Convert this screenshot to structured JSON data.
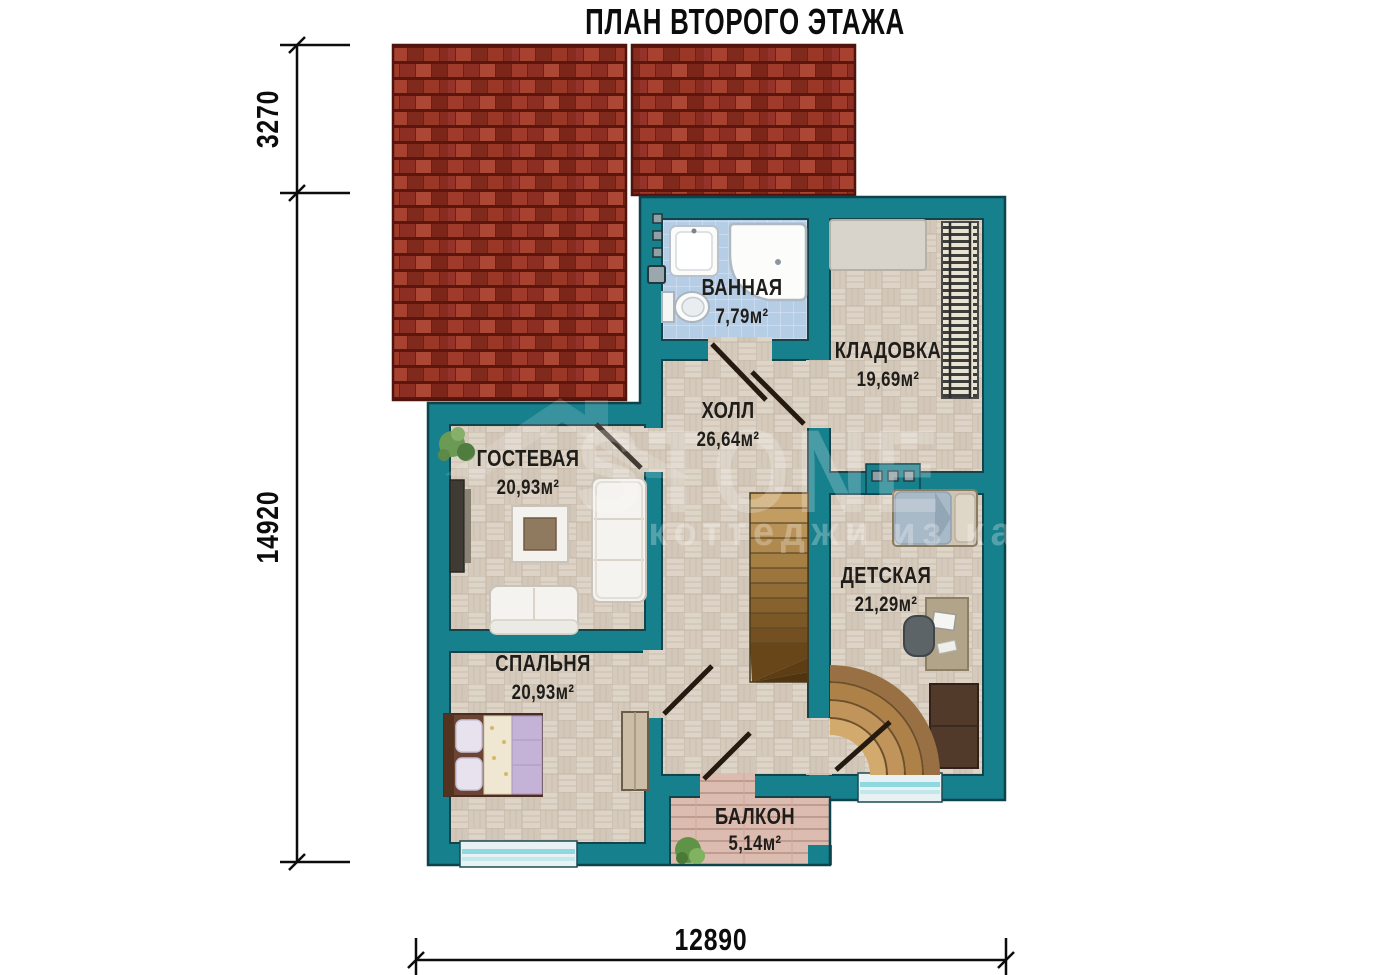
{
  "title": "ПЛАН ВТОРОГО ЭТАЖА",
  "rooms": [
    {
      "name": "ВАННАЯ",
      "area": "7,79м²"
    },
    {
      "name": "КЛАДОВКА",
      "area": "19,69м²"
    },
    {
      "name": "ХОЛЛ",
      "area": "26,64м²"
    },
    {
      "name": "ГОСТЕВАЯ",
      "area": "20,93м²"
    },
    {
      "name": "ДЕТСКАЯ",
      "area": "21,29м²"
    },
    {
      "name": "СПАЛЬНЯ",
      "area": "20,93м²"
    },
    {
      "name": "БАЛКОН",
      "area": "5,14м²"
    }
  ],
  "dimensions": {
    "roof_height": "3270",
    "plan_height": "14920",
    "plan_width": "12890"
  },
  "watermark": {
    "brand": "STONE",
    "tagline": "коттеджи из камня"
  },
  "colors": {
    "wall_teal": "#17808d",
    "roof_red": "#9c3a2b",
    "floor_beige": "#d9cfc2",
    "bath_tile_blue": "#b6cde6",
    "balcony_deck": "#dcbcb0",
    "window_cyan": "#8fd8e0",
    "dimension_black": "#0c0c0c"
  }
}
